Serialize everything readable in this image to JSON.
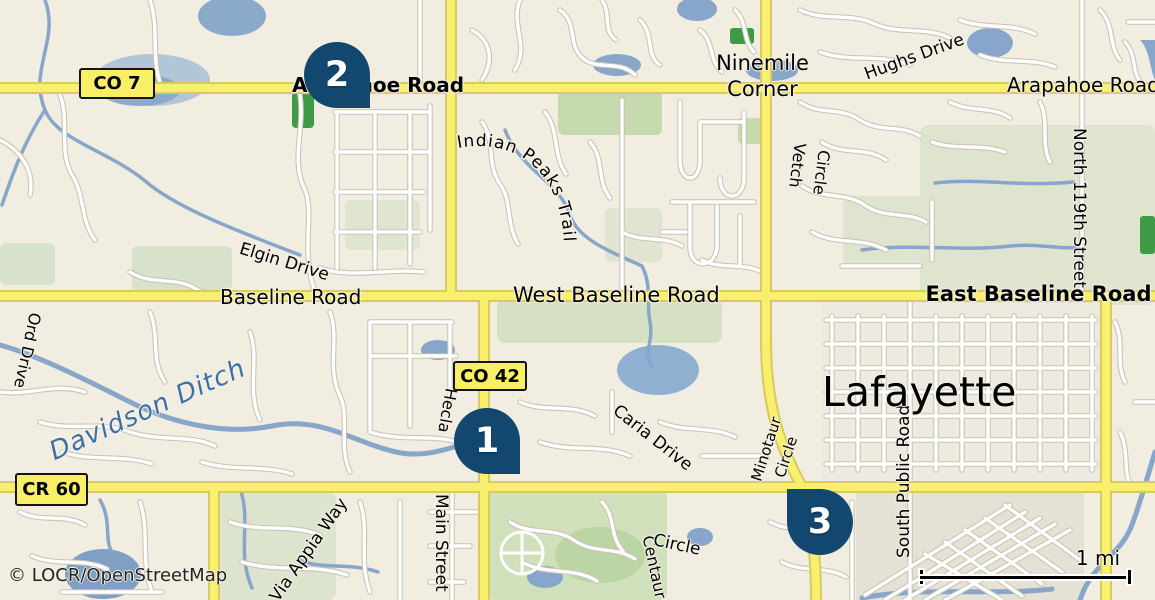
{
  "map": {
    "attribution": "© LOCR/OpenStreetMap",
    "scale": {
      "label": "1 mi"
    },
    "badges": {
      "co7": "CO 7",
      "co42": "CO 42",
      "cr60": "CR 60"
    },
    "markers": {
      "m1": "1",
      "m2": "2",
      "m3": "3"
    },
    "places": {
      "ninemile_line1": "Ninemile",
      "ninemile_line2": "Corner",
      "lafayette": "Lafayette"
    },
    "roads": {
      "arapahoe_west": "Arapahoe Road",
      "arapahoe_east": "Arapahoe Road",
      "hughs_drive": "Hughs Drive",
      "indian_peaks_trail": "Indian Peaks Trail",
      "elgin_drive": "Elgin Drive",
      "baseline_road": "Baseline Road",
      "west_baseline_road": "West Baseline Road",
      "east_baseline_road": "East Baseline Road",
      "north_119th_street": "North 119th Street",
      "vetch": "Vetch",
      "vetch_circle_word": "Circle",
      "hecla": "Hecla",
      "ord_drive": "Ord Drive",
      "caria_drive": "Caria Drive",
      "minotaur": "Minotaur",
      "minotaur_circle_word": "Circle",
      "main_street": "Main Street",
      "via_appia_way": "Via Appia Way",
      "centaur": "Centaur",
      "centaur_circle_word": "Circle",
      "south_public_road": "South Public Road"
    },
    "water_labels": {
      "davidson_ditch": "Davidson Ditch"
    },
    "colors": {
      "background": "#f1ede1",
      "major_road": "#f9ef6e",
      "water": "#87a6c9",
      "green": "#cfe0ba",
      "marker": "#12486f",
      "badge": "#f8ef67"
    }
  }
}
